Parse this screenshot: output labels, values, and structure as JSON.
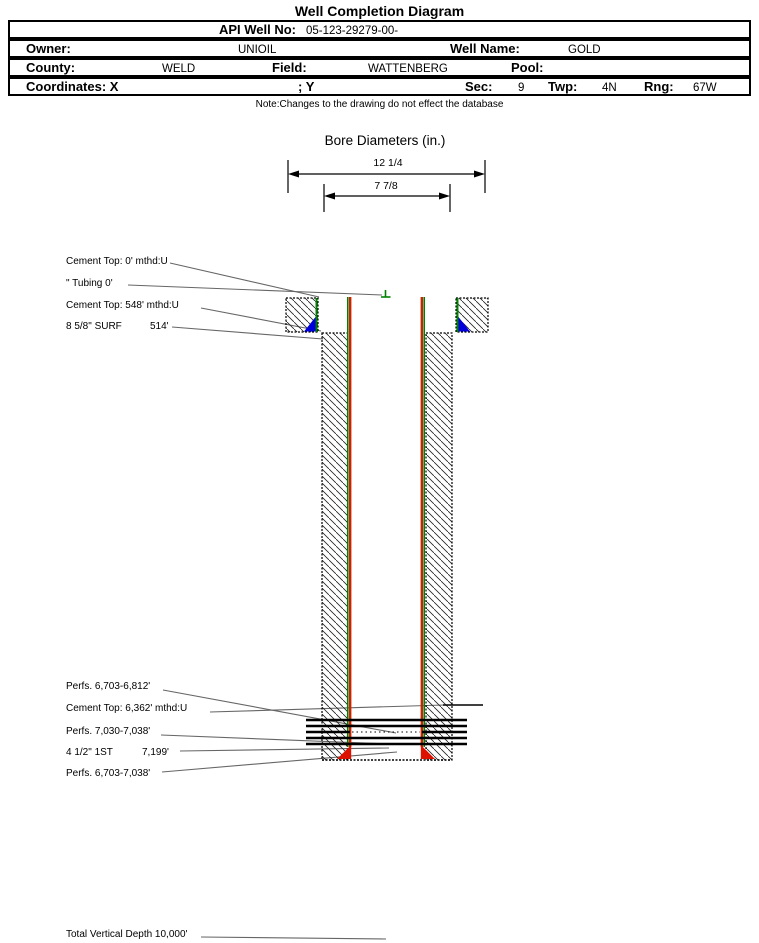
{
  "title": "Well Completion Diagram",
  "header": {
    "api": {
      "label": "API Well No:",
      "value": "05-123-29279-00-"
    },
    "owner": {
      "label": "Owner:",
      "value": "UNIOIL"
    },
    "well_name": {
      "label": "Well Name:",
      "value": "GOLD"
    },
    "county": {
      "label": "County:",
      "value": "WELD"
    },
    "field": {
      "label": "Field:",
      "value": "WATTENBERG"
    },
    "pool": {
      "label": "Pool:",
      "value": ""
    },
    "coordinates": {
      "label": "Coordinates: X",
      "y_label": "; Y"
    },
    "sec": {
      "label": "Sec:",
      "value": "9"
    },
    "twp": {
      "label": "Twp:",
      "value": "4N"
    },
    "rng": {
      "label": "Rng:",
      "value": "67W"
    }
  },
  "note": "Note:Changes to the drawing do not effect the database",
  "bore_diameters": {
    "title": "Bore Diameters (in.)",
    "outer": "12 1/4",
    "inner": "7 7/8"
  },
  "annotations": {
    "cement_top_surface": "Cement Top: 0' mthd:U",
    "tubing": "\" Tubing 0'",
    "cement_top_548": "Cement Top: 548' mthd:U",
    "surface_casing": "8 5/8\" SURF",
    "surface_casing_depth": "514'",
    "perfs_upper": "Perfs. 6,703-6,812'",
    "cement_top_6362": "Cement Top: 6,362' mthd:U",
    "perfs_mid": "Perfs. 7,030-7,038'",
    "production_casing": "4 1/2\" 1ST",
    "production_casing_depth": "7,199'",
    "perfs_lower": "Perfs. 6,703-7,038'",
    "total_vertical_depth": "Total Vertical Depth 10,000'"
  },
  "colors": {
    "casing_green": "#008000",
    "tubing_red": "#cc2200",
    "cement_shoe_blue": "#0000dd",
    "casing_shoe_red": "#dd1100",
    "hatch": "#222222"
  }
}
